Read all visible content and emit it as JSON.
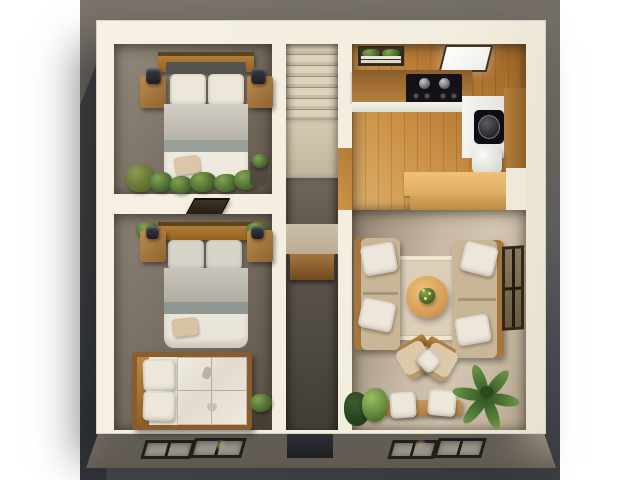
{
  "scene": {
    "type": "3d-floor-plan-render",
    "title": "Top-down 3D render of a small two-bedroom apartment floor plan",
    "palette": {
      "page_margin": "#ffffff",
      "backdrop_top": "#7a746b",
      "backdrop_bottom": "#3a3c41",
      "walls": "#f2edde",
      "bedroom_floor": "#7e7467",
      "kitchen_floor": "#c08a46",
      "living_floor": "#c9bca8",
      "wood_furniture": "#a97c46",
      "bedding_white": "#ece7da",
      "plant_green": "#55742f",
      "appliance_black": "#131317"
    },
    "rooms": [
      {
        "label": "Bedroom 1",
        "position": "top-left",
        "furniture": [
          "double bed with wooden headboard, two white pillows, grey blanket, sage band, white duvet and tan accent pillow",
          "left nightstand with black lamp",
          "right nightstand with black lamp",
          "green bean bag",
          "row of plants along foot wall",
          "dark planter"
        ]
      },
      {
        "label": "Bedroom 2",
        "position": "middle-left",
        "furniture": [
          "double bed with wooden headboard and grey bedding",
          "two nightstands with plants and black lamps",
          "dark skylight vent on dividing wall"
        ]
      },
      {
        "label": "Bathroom / daybed nook",
        "position": "bottom-left",
        "furniture": [
          "wood-framed daybed with two white cushions",
          "glazed white panel with grid",
          "potted plant on dark stand"
        ]
      },
      {
        "label": "Staircase",
        "position": "top-center",
        "furniture": [
          "seven stair treads",
          "beige landing"
        ]
      },
      {
        "label": "Hallway",
        "position": "center",
        "furniture": [
          "wooden wall shelf",
          "dark floor"
        ]
      },
      {
        "label": "Kitchen",
        "position": "top-right",
        "furniture": [
          "window with greenery and white sill slats",
          "glowing white skylight panel",
          "wood counter with black cooktop (two knobs, four burners)",
          "lit white counter front",
          "black round sink in white counter",
          "wood side counter",
          "white fridge",
          "wood breakfast bar"
        ]
      },
      {
        "label": "Living room",
        "position": "bottom-right",
        "furniture": [
          "left sofa with two white pillows",
          "right sofa with two white pillows",
          "square beige rug",
          "round wooden coffee table with flowering plant",
          "angled lounge chair with white throw pillow",
          "wooden bench with two white cushions",
          "corner plants",
          "large palm plant",
          "dark-framed window on right wall"
        ]
      }
    ],
    "facade": {
      "label": "Front facade",
      "features": [
        "pair of slanted windows with warm interior glow (left)",
        "recessed dark entry",
        "pair of slanted windows with warm interior glow (right)"
      ]
    }
  }
}
